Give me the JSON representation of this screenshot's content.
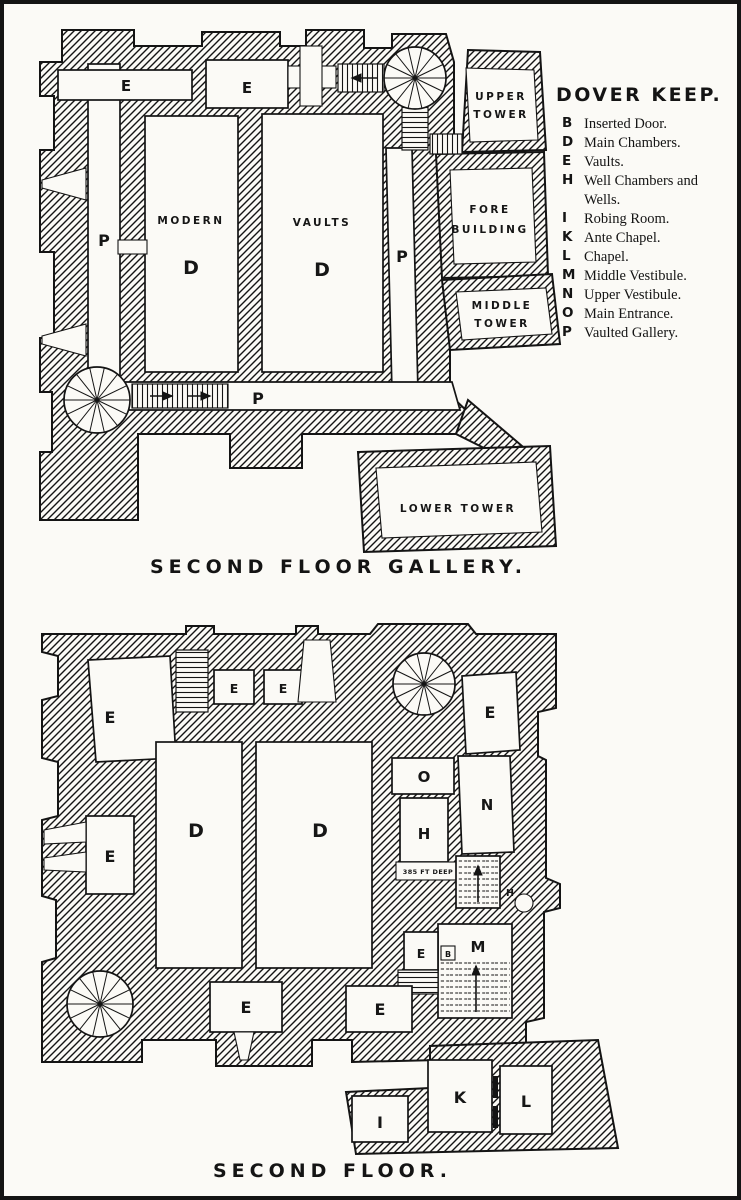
{
  "legend": {
    "title": "DOVER KEEP.",
    "entries": [
      {
        "key": "B",
        "label": "Inserted Door."
      },
      {
        "key": "D",
        "label": "Main Chambers."
      },
      {
        "key": "E",
        "label": "Vaults."
      },
      {
        "key": "H",
        "label": "Well Chambers and Wells."
      },
      {
        "key": "I",
        "label": "Robing Room."
      },
      {
        "key": "K",
        "label": "Ante Chapel."
      },
      {
        "key": "L",
        "label": "Chapel."
      },
      {
        "key": "M",
        "label": "Middle Vestibule."
      },
      {
        "key": "N",
        "label": "Upper Vestibule."
      },
      {
        "key": "O",
        "label": "Main Entrance."
      },
      {
        "key": "P",
        "label": "Vaulted Gallery."
      }
    ]
  },
  "plans": {
    "gallery": {
      "caption": "SECOND FLOOR GALLERY.",
      "labels": {
        "vault_nw": "E",
        "vault_n": "E",
        "gallery_w": "P",
        "gallery_e": "P",
        "gallery_s": "P",
        "modern_word": "MODERN",
        "modern_letter": "D",
        "vaults_word": "VAULTS",
        "vaults_letter": "D",
        "upper_tower_l1": "UPPER",
        "upper_tower_l2": "TOWER",
        "fore_l1": "FORE",
        "fore_l2": "BUILDING",
        "middle_l1": "MIDDLE",
        "middle_l2": "TOWER",
        "lower_tower": "LOWER TOWER"
      }
    },
    "second": {
      "caption": "SECOND FLOOR.",
      "labels": {
        "vault_nw": "E",
        "vault_n1": "E",
        "vault_n2": "E",
        "vault_ne": "E",
        "vault_w": "E",
        "chamber_left": "D",
        "chamber_right": "D",
        "entrance_o": "O",
        "well_h": "H",
        "vestibule_n": "N",
        "vestibule_m": "M",
        "vault_mid": "E",
        "door_b": "B",
        "vault_s1": "E",
        "vault_s2": "E",
        "ante_chapel_k": "K",
        "chapel_l": "L",
        "robing_i": "I",
        "well_small_h": "H",
        "well_depth": "385 FT DEEP"
      }
    }
  }
}
